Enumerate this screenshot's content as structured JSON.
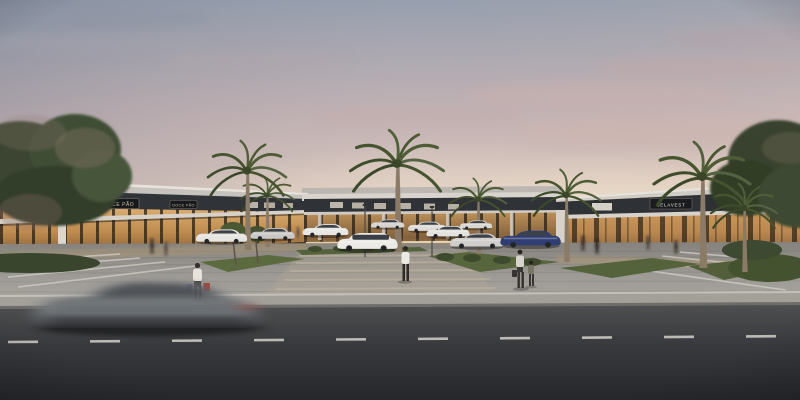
{
  "scene": {
    "description": "Photorealistic architectural rendering at dusk of a U-shaped single-story strip-mall shopping center with warm-lit glass storefronts, dark signage fascia bands, palm trees, landscaped parking lot with white and silver parked cars and one dark-blue sedan, pedestrians carrying shopping bags, and a motion-blurred car passing on the foreground road",
    "time_of_day": "dusk",
    "style": "photorealistic render"
  },
  "signs": {
    "doce_pao_main": "DOCE PÃO",
    "doce_pao_small": "DOCE PÃO",
    "belavest": "BELAVEST"
  },
  "objects": {
    "palm_trees": 7,
    "parked_cars": 10,
    "moving_cars": 1,
    "pedestrians_foreground": 4
  },
  "colors": {
    "sky_top": "#97a0b0",
    "sky_mid": "#c4b4b6",
    "sky_horizon": "#eedcc6",
    "sun_glow": "#f6e9d0",
    "fascia_light": "#d8d4cd",
    "sign_band": "#2f3237",
    "storefront_glow": "#d8a662",
    "foliage": "#46552f",
    "pavement": "#9d9a95",
    "road": "#3a3b3e",
    "lane_marking": "#d2d0ca",
    "car_white": "#eceae6",
    "car_blue": "#2f3d72",
    "motion_car": "#6d7276"
  }
}
